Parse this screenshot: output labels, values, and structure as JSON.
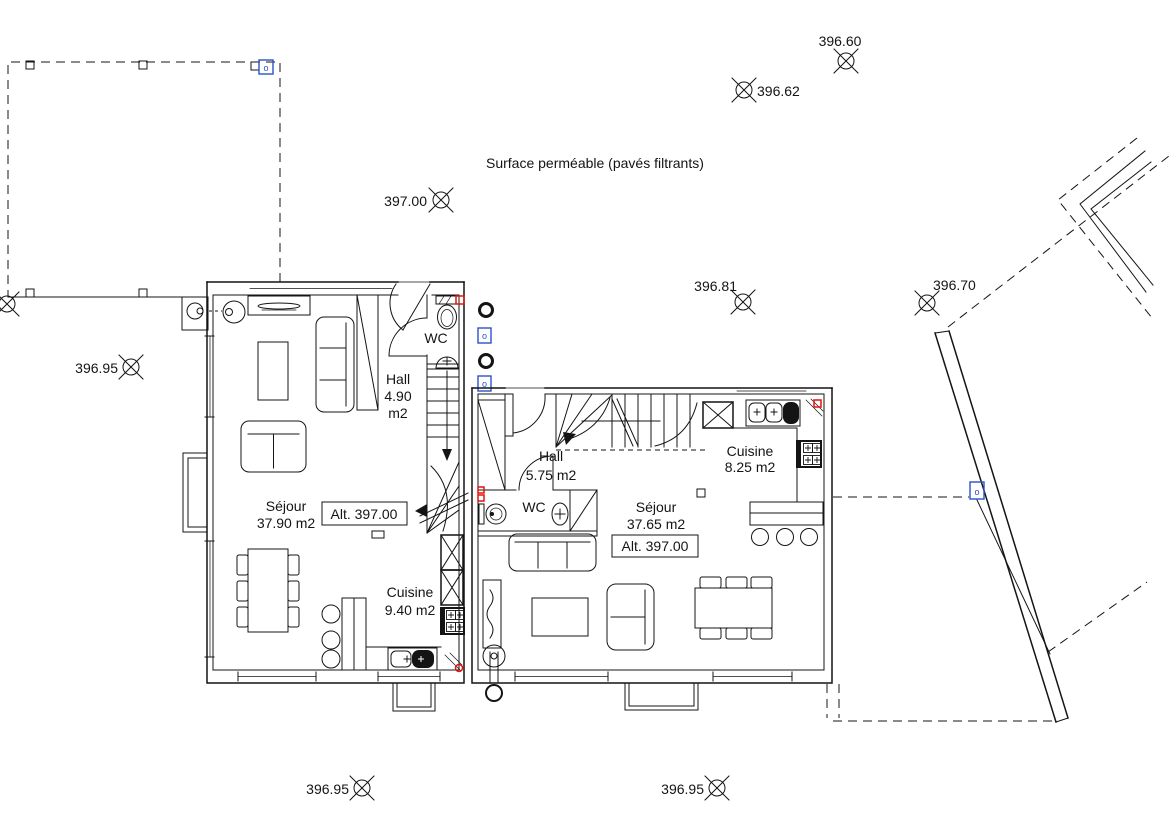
{
  "plan": {
    "surface_label": "Surface perméable (pavés filtrants)",
    "unit_left": {
      "sejour": {
        "name": "Séjour",
        "area": "37.90 m2"
      },
      "cuisine": {
        "name": "Cuisine",
        "area": "9.40 m2"
      },
      "hall": {
        "name": "Hall",
        "area_value": "4.90",
        "area_unit": "m2"
      },
      "wc": {
        "name": "WC"
      },
      "altitude": "Alt. 397.00"
    },
    "unit_right": {
      "sejour": {
        "name": "Séjour",
        "area": "37.65 m2"
      },
      "cuisine": {
        "name": "Cuisine",
        "area": "8.25 m2"
      },
      "hall": {
        "name": "Hall",
        "area": "5.75 m2"
      },
      "wc": {
        "name": "WC"
      },
      "altitude": "Alt. 397.00"
    },
    "elevations": {
      "top": "396.60",
      "upper_mid": "396.62",
      "court": "397.00",
      "between": "396.81",
      "east": "396.70",
      "west": "396.95",
      "bottom_left": "396.95",
      "bottom_right": "396.95"
    },
    "symbols": {
      "port_marker": "o"
    },
    "colors": {
      "line": "#141414",
      "blue": "#2a52c9",
      "red": "#e3140c",
      "background": "#ffffff"
    }
  }
}
